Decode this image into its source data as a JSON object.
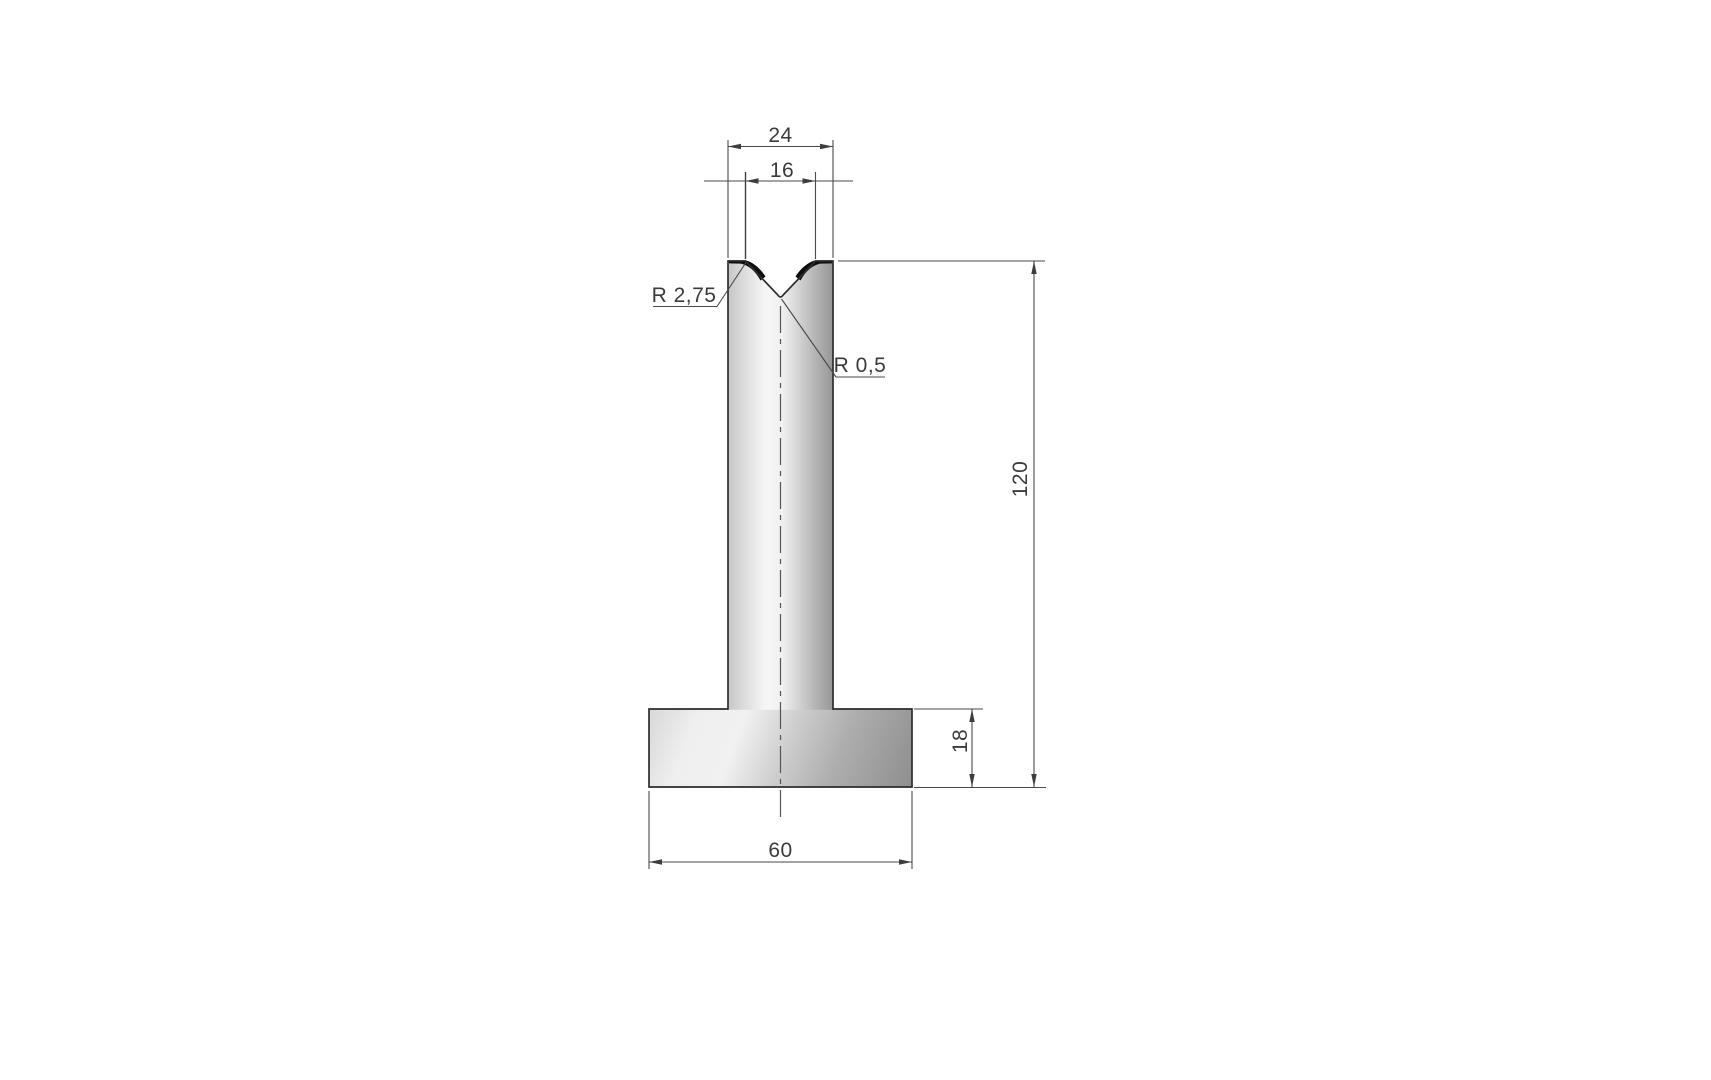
{
  "drawing": {
    "kind": "t-die-cross-section-technical-drawing",
    "dimensions": {
      "top_width": "24",
      "vee_opening": "16",
      "total_height": "120",
      "base_height": "18",
      "base_width": "60"
    },
    "radii": {
      "shoulder": "R 2,75",
      "vertex": "R 0,5"
    },
    "colors": {
      "background": "#ffffff",
      "aux_line": "#4a4a4a",
      "outline": "#2d2d2d",
      "text": "#3b3b3b",
      "metal_light": "#f7f7f7",
      "metal_mid": "#c4c4c4",
      "metal_dark": "#8f8f8f",
      "corner_fill": "#0d0d0d"
    }
  }
}
